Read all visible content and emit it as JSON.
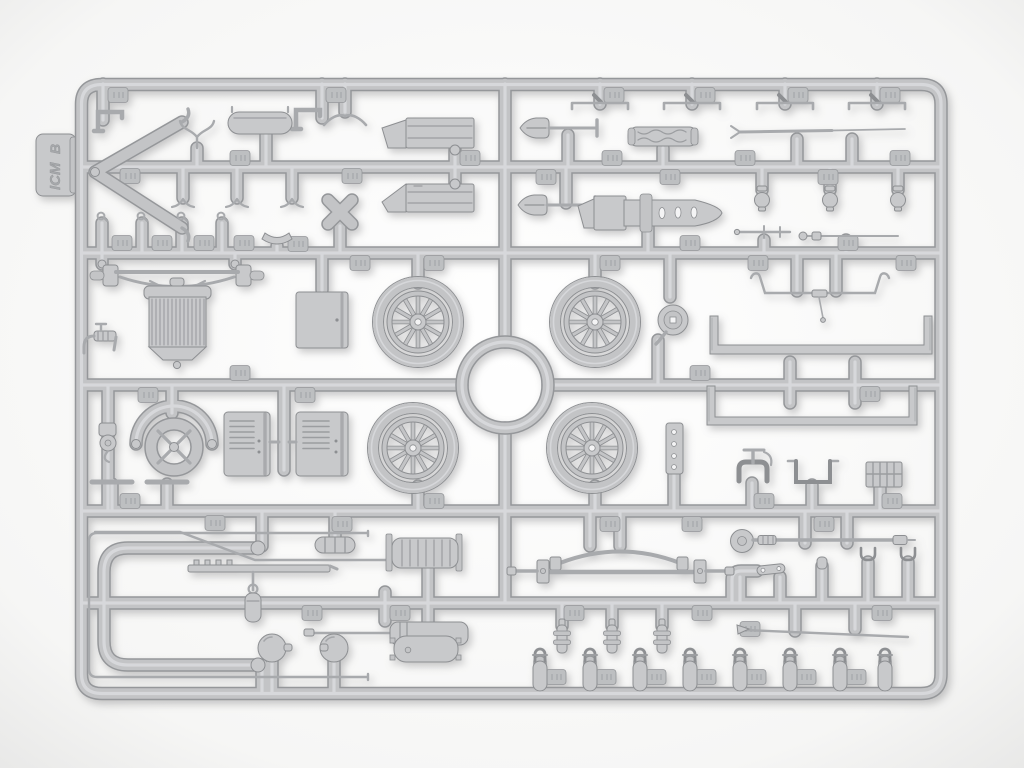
{
  "scene": {
    "description": "Photograph of a light-grey injection-molded model kit sprue (runner frame) holding Model T car parts",
    "sprue_letter": "B",
    "brand": "ICM"
  },
  "tab": {
    "brand_label": "ICM",
    "letter_label": "B"
  },
  "colors": {
    "bg": "#f6f6f5",
    "vig-center": "#ffffff",
    "vig-edge": "#e8e8e7",
    "tube-edge": "#95979a",
    "tube-mid": "#c3c4c6",
    "tube-hi": "#dbdcde",
    "part-fill": "#c8c9cb",
    "part-edge": "#8d8f92",
    "detail": "#9b9da0",
    "rod": "#a8aaad",
    "pad": "#bdbfc1",
    "bg-hole": "#f4f4f5"
  },
  "parts": [
    "spoked-wheel x4",
    "center-ring-runner",
    "radiator",
    "front-axle-with-spring",
    "hood-panel",
    "louvered-hood-side-panels x2",
    "steering-wheel-with-column-arc",
    "shovel x2",
    "rolled-tarp",
    "tent-pole",
    "boat-shaped-pan",
    "frame-rail x2",
    "exhaust-c-pipe",
    "muffler-small",
    "muffler-large",
    "fuel-tank",
    "grease-gun",
    "headlamp-ball x2",
    "rear-axle-with-spring",
    "starting-crank",
    "pipe-elbow",
    "shackle x8",
    "spring-perch x3",
    "lamp x3",
    "bracket-bar x4",
    "chevron-brace",
    "x-brace",
    "saddle-clip",
    "hooked-cylinder x4",
    "engine-step-block x2",
    "petcock-tap x2",
    "holed-strip",
    "open-box-bracket",
    "waffle-plate",
    "part-number-pads"
  ]
}
